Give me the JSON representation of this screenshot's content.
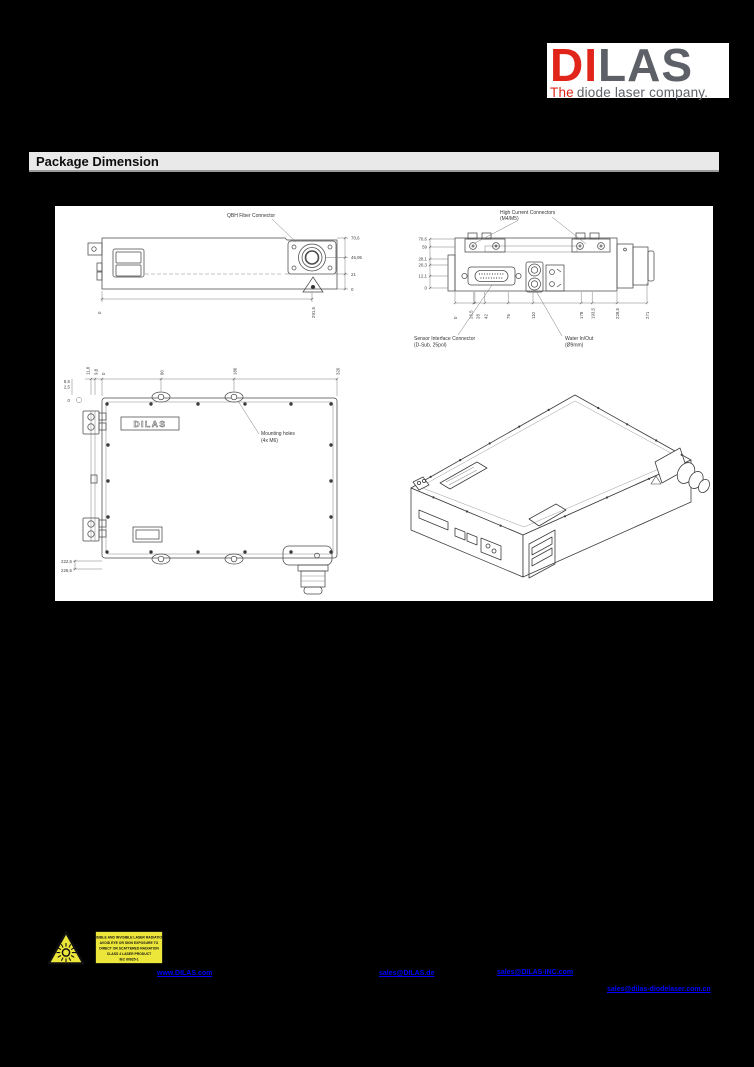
{
  "page": {
    "bg": "#000000"
  },
  "logo": {
    "di": "DI",
    "las": "LAS",
    "tag_the": "The",
    "tag_rest": "diode laser company.",
    "red": "#e1251b",
    "gray": "#5d6167"
  },
  "section": {
    "title": "Package Dimension"
  },
  "drawings": {
    "side": {
      "fiber_label": "QBH Fiber Connector",
      "dims_right": [
        "70,6",
        "46,95",
        "21",
        "0"
      ],
      "dims_bottom": [
        "0",
        "291,5"
      ]
    },
    "rear": {
      "hc_label1": "High Current Connectors",
      "hc_label2": "(M4/M5)",
      "sensor_label1": "Sensor Interface Connector",
      "sensor_label2": "(D-Sub, 25pol)",
      "water_label1": "Water In/Out",
      "water_label2": "(Ø9mm)",
      "dims_left": [
        "70,6",
        "59",
        "28,1",
        "20,3",
        "12,1",
        "0"
      ],
      "dims_bottom": [
        "0",
        "26,5",
        "28",
        "42",
        "75",
        "110",
        "178",
        "193,5",
        "228,5",
        "271"
      ]
    },
    "top": {
      "mounting_label1": "Mounting holes",
      "mounting_label2": "(4x M6)",
      "brand": "DILAS",
      "dims_top": [
        "11,8",
        "9,8",
        "0",
        "80",
        "180",
        "320"
      ],
      "dims_left_top": [
        "8,5",
        "2,5",
        "0"
      ],
      "dims_left_bottom": [
        "222,5",
        "228,5"
      ]
    }
  },
  "warning": {
    "bg": "#ede63a",
    "lines": [
      "VISIBLE AND INVISIBLE LASER RADIATION",
      "AVOID EYE OR SKIN EXPOSURE TO",
      "DIRECT OR SCATTERED RADIATION",
      "CLASS 4 LASER PRODUCT",
      "IEC 60825-1"
    ]
  },
  "footer": {
    "links": [
      {
        "label": "www.DILAS.com"
      },
      {
        "label": "sales@DILAS.de"
      },
      {
        "label": "sales@DILAS-INC.com"
      },
      {
        "label": "sales@dilas-diodelaser.com.cn"
      }
    ]
  }
}
